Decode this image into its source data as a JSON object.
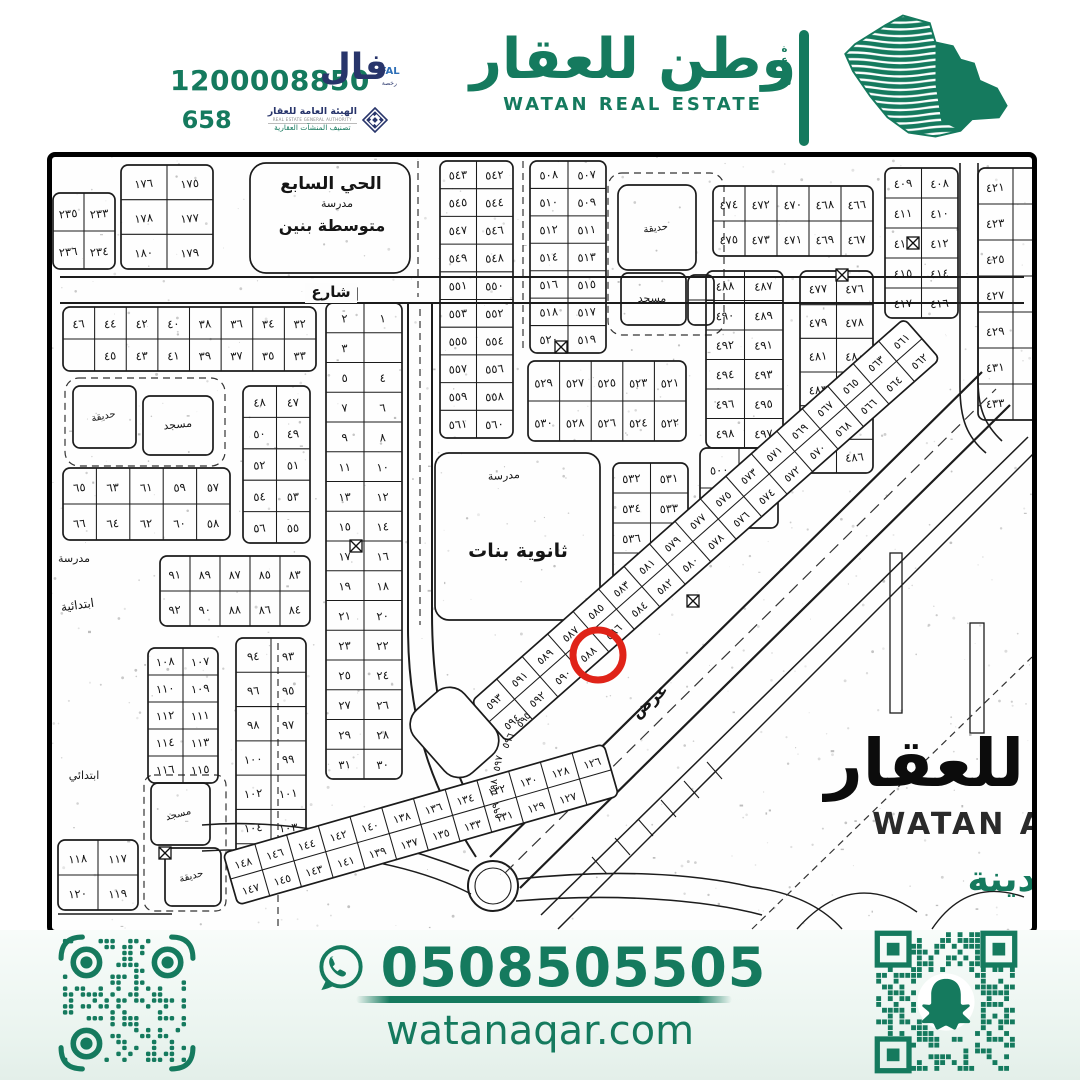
{
  "meta": {
    "accent": "#157a5e",
    "navy": "#28356b",
    "red": "#e02318",
    "ink": "#151515"
  },
  "header": {
    "license_number": "1200008850",
    "license_secondary": "658",
    "fal": {
      "ar": "فال",
      "en": "FAL",
      "sub": "رخصة"
    },
    "authority": {
      "name_ar": "الهيئة العامة للعقار",
      "name_en": "REAL ESTATE GENERAL AUTHORITY",
      "classification": "تصنيف المنشآت العقارية"
    },
    "brand": {
      "name_ar": "وطن للعقار",
      "name_en": "WATAN REAL ESTATE",
      "side_ar": "شمعة"
    }
  },
  "footer": {
    "phone": "0508505505",
    "website": "watanaqar.com"
  },
  "map": {
    "highlight": {
      "plot": "٥٨٩",
      "x": 546,
      "y": 498,
      "r": 25,
      "color": "#e02318"
    },
    "watermark": {
      "ar": "للعقار",
      "en": "WATAN A",
      "city": "دينة"
    },
    "landmarks": [
      {
        "text": "الحي السابع",
        "x": 279,
        "y": 32,
        "size": 17,
        "bold": 1
      },
      {
        "text": "مدرسة",
        "x": 285,
        "y": 50,
        "size": 11
      },
      {
        "text": "متوسطة بنين",
        "x": 280,
        "y": 74,
        "size": 16,
        "bold": 1
      },
      {
        "text": "شارع",
        "x": 279,
        "y": 140,
        "size": 15,
        "bold": 1,
        "bg": 1
      },
      {
        "text": "حديقة",
        "x": 52,
        "y": 262,
        "size": 10,
        "rot": -12
      },
      {
        "text": "مسجد",
        "x": 126,
        "y": 271,
        "size": 11,
        "rot": -6
      },
      {
        "text": "مدرسة",
        "x": 22,
        "y": 405,
        "size": 11
      },
      {
        "text": "ابتدائية",
        "x": 26,
        "y": 452,
        "size": 12,
        "rot": -8
      },
      {
        "text": "مدرسة",
        "x": 452,
        "y": 322,
        "size": 11,
        "rot": -4
      },
      {
        "text": "ثانوية بنات",
        "x": 466,
        "y": 400,
        "size": 19,
        "bold": 1
      },
      {
        "text": "حديقة",
        "x": 604,
        "y": 74,
        "size": 10,
        "rot": -8
      },
      {
        "text": "مسجد",
        "x": 600,
        "y": 145,
        "size": 11
      },
      {
        "text": "ابتدائي",
        "x": 32,
        "y": 622,
        "size": 11
      },
      {
        "text": "مسجد",
        "x": 127,
        "y": 660,
        "size": 10,
        "rot": -15
      },
      {
        "text": "حديقة",
        "x": 140,
        "y": 722,
        "size": 10,
        "rot": -15
      },
      {
        "text": "عرض",
        "x": 601,
        "y": 548,
        "size": 16,
        "rot": -41,
        "bold": 1
      },
      {
        "text": "٥٩٥",
        "x": 474,
        "y": 565,
        "size": 10,
        "rot": -50
      },
      {
        "text": "٥٩٦",
        "x": 459,
        "y": 585,
        "size": 10,
        "rot": -65
      },
      {
        "text": "٥٩٧",
        "x": 449,
        "y": 607,
        "size": 10,
        "rot": -78
      },
      {
        "text": "٥٩٨",
        "x": 445,
        "y": 630,
        "size": 10,
        "rot": -90
      },
      {
        "text": "٥٩٩",
        "x": 448,
        "y": 653,
        "size": 10,
        "rot": -104
      }
    ],
    "blocks": [
      {
        "x": 1,
        "y": 36,
        "w": 62,
        "h": 76,
        "cols": 2,
        "rows": 2,
        "labels": [
          [
            "٢٣٥",
            "٢٣٣"
          ],
          [
            "٢٣٦",
            "٢٣٤"
          ]
        ]
      },
      {
        "x": 69,
        "y": 8,
        "w": 92,
        "h": 104,
        "cols": 2,
        "rows": 3,
        "labels": [
          [
            "١٧٦",
            "١٧٥"
          ],
          [
            "١٧٨",
            "١٧٧"
          ],
          [
            "١٨٠",
            "١٧٩"
          ]
        ]
      },
      {
        "x": 198,
        "y": 6,
        "w": 160,
        "h": 110,
        "cols": 1,
        "rows": 1,
        "rx": 16,
        "labels": [
          [
            ""
          ]
        ]
      },
      {
        "x": 11,
        "y": 150,
        "w": 253,
        "h": 64,
        "cols": 8,
        "rows": 2,
        "labels": [
          [
            "٤٦",
            "٤٤",
            "٤٢",
            "٤٠",
            "٣٨",
            "٣٦",
            "٣٤",
            "٣٢"
          ],
          [
            "",
            "٤٥",
            "٤٣",
            "٤١",
            "٣٩",
            "٣٧",
            "٣٥",
            "٣٣"
          ]
        ]
      },
      {
        "x": 274,
        "y": 146,
        "w": 76,
        "h": 476,
        "cols": 2,
        "rows": 16,
        "labels": [
          [
            "٢",
            "١"
          ],
          [
            "٣",
            ""
          ],
          [
            "٥",
            "٤"
          ],
          [
            "٧",
            "٦"
          ],
          [
            "٩",
            "٨"
          ],
          [
            "١١",
            "١٠"
          ],
          [
            "١٣",
            "١٢"
          ],
          [
            "١٥",
            "١٤"
          ],
          [
            "١٧",
            "١٦"
          ],
          [
            "١٩",
            "١٨"
          ],
          [
            "٢١",
            "٢٠"
          ],
          [
            "٢٣",
            "٢٢"
          ],
          [
            "٢٥",
            "٢٤"
          ],
          [
            "٢٧",
            "٢٦"
          ],
          [
            "٢٩",
            "٢٨"
          ],
          [
            "٣١",
            "٣٠"
          ]
        ]
      },
      {
        "x": 21,
        "y": 229,
        "w": 63,
        "h": 62,
        "cols": 1,
        "rows": 1,
        "labels": [
          [
            ""
          ]
        ]
      },
      {
        "x": 91,
        "y": 239,
        "w": 70,
        "h": 59,
        "cols": 1,
        "rows": 1,
        "labels": [
          [
            ""
          ]
        ]
      },
      {
        "x": 191,
        "y": 229,
        "w": 67,
        "h": 157,
        "cols": 2,
        "rows": 5,
        "labels": [
          [
            "٤٨",
            "٤٧"
          ],
          [
            "٥٠",
            "٤٩"
          ],
          [
            "٥٢",
            "٥١"
          ],
          [
            "٥٤",
            "٥٣"
          ],
          [
            "٥٦",
            "٥٥"
          ]
        ]
      },
      {
        "x": 11,
        "y": 311,
        "w": 167,
        "h": 72,
        "cols": 5,
        "rows": 2,
        "labels": [
          [
            "٦٥",
            "٦٣",
            "٦١",
            "٥٩",
            "٥٧"
          ],
          [
            "٦٦",
            "٦٤",
            "٦٢",
            "٦٠",
            "٥٨"
          ]
        ]
      },
      {
        "x": 108,
        "y": 399,
        "w": 150,
        "h": 70,
        "cols": 5,
        "rows": 2,
        "labels": [
          [
            "٩١",
            "٨٩",
            "٨٧",
            "٨٥",
            "٨٣"
          ],
          [
            "٩٢",
            "٩٠",
            "٨٨",
            "٨٦",
            "٨٤"
          ]
        ]
      },
      {
        "x": 184,
        "y": 481,
        "w": 70,
        "h": 240,
        "cols": 2,
        "rows": 7,
        "labels": [
          [
            "٩٤",
            "٩٣"
          ],
          [
            "٩٦",
            "٩٥"
          ],
          [
            "٩٨",
            "٩٧"
          ],
          [
            "١٠٠",
            "٩٩"
          ],
          [
            "١٠٢",
            "١٠١"
          ],
          [
            "١٠٤",
            "١٠٣"
          ],
          [
            "١٠٦",
            "١٠٥"
          ]
        ]
      },
      {
        "x": 96,
        "y": 491,
        "w": 70,
        "h": 135,
        "cols": 2,
        "rows": 5,
        "labels": [
          [
            "١٠٨",
            "١٠٧"
          ],
          [
            "١١٠",
            "١٠٩"
          ],
          [
            "١١٢",
            "١١١"
          ],
          [
            "١١٤",
            "١١٣"
          ],
          [
            "١١٦",
            "١١٥"
          ]
        ]
      },
      {
        "x": 99,
        "y": 626,
        "w": 59,
        "h": 62,
        "cols": 1,
        "rows": 1,
        "labels": [
          [
            ""
          ]
        ]
      },
      {
        "x": 113,
        "y": 691,
        "w": 56,
        "h": 58,
        "cols": 1,
        "rows": 1,
        "labels": [
          [
            ""
          ]
        ]
      },
      {
        "x": 6,
        "y": 683,
        "w": 80,
        "h": 70,
        "cols": 2,
        "rows": 2,
        "labels": [
          [
            "١١٨",
            "١١٧"
          ],
          [
            "١٢٠",
            "١١٩"
          ]
        ]
      },
      {
        "x": 383,
        "y": 296,
        "w": 165,
        "h": 167,
        "cols": 1,
        "rows": 1,
        "rx": 14,
        "labels": [
          [
            ""
          ]
        ]
      },
      {
        "x": 561,
        "y": 306,
        "w": 75,
        "h": 120,
        "cols": 2,
        "rows": 4,
        "labels": [
          [
            "٥٣٢",
            "٥٣١"
          ],
          [
            "٥٣٤",
            "٥٣٣"
          ],
          [
            "٥٣٦",
            "٥٣٥"
          ],
          [
            "",
            "٥٣٧"
          ]
        ]
      },
      {
        "x": 388,
        "y": 4,
        "w": 73,
        "h": 277,
        "cols": 2,
        "rows": 10,
        "labels": [
          [
            "٥٤٣",
            "٥٤٢"
          ],
          [
            "٥٤٥",
            "٥٤٤"
          ],
          [
            "٥٤٧",
            "٥٤٦"
          ],
          [
            "٥٤٩",
            "٥٤٨"
          ],
          [
            "٥٥١",
            "٥٥٠"
          ],
          [
            "٥٥٣",
            "٥٥٢"
          ],
          [
            "٥٥٥",
            "٥٥٤"
          ],
          [
            "٥٥٧",
            "٥٥٦"
          ],
          [
            "٥٥٩",
            "٥٥٨"
          ],
          [
            "٥٦١",
            "٥٦٠"
          ]
        ]
      },
      {
        "x": 478,
        "y": 4,
        "w": 76,
        "h": 192,
        "cols": 2,
        "rows": 7,
        "labels": [
          [
            "٥٠٨",
            "٥٠٧"
          ],
          [
            "٥١٠",
            "٥٠٩"
          ],
          [
            "٥١٢",
            "٥١١"
          ],
          [
            "٥١٤",
            "٥١٣"
          ],
          [
            "٥١٦",
            "٥١٥"
          ],
          [
            "٥١٨",
            "٥١٧"
          ],
          [
            "٥٢٠",
            "٥١٩"
          ]
        ]
      },
      {
        "x": 566,
        "y": 28,
        "w": 78,
        "h": 85,
        "cols": 1,
        "rows": 1,
        "rx": 10,
        "labels": [
          [
            ""
          ]
        ]
      },
      {
        "x": 569,
        "y": 116,
        "w": 65,
        "h": 52,
        "cols": 1,
        "rows": 1,
        "labels": [
          [
            ""
          ]
        ]
      },
      {
        "x": 636,
        "y": 118,
        "w": 26,
        "h": 50,
        "cols": 1,
        "rows": 2,
        "labels": [
          [
            ""
          ],
          [
            ""
          ]
        ]
      },
      {
        "x": 476,
        "y": 204,
        "w": 158,
        "h": 80,
        "cols": 5,
        "rows": 2,
        "labels": [
          [
            "٥٢٩",
            "٥٢٧",
            "٥٢٥",
            "٥٢٣",
            "٥٢١"
          ],
          [
            "٥٣٠",
            "٥٢٨",
            "٥٢٦",
            "٥٢٤",
            "٥٢٢"
          ]
        ]
      },
      {
        "x": 648,
        "y": 291,
        "w": 78,
        "h": 80,
        "cols": 2,
        "rows": 2,
        "labels": [
          [
            "٥٠٠",
            "٤٩٩"
          ],
          [
            "٥٠٢",
            "٥٠١"
          ]
        ]
      },
      {
        "x": 661,
        "y": 29,
        "w": 160,
        "h": 70,
        "cols": 5,
        "rows": 2,
        "labels": [
          [
            "٤٧٤",
            "٤٧٢",
            "٤٧٠",
            "٤٦٨",
            "٤٦٦"
          ],
          [
            "٤٧٥",
            "٤٧٣",
            "٤٧١",
            "٤٦٩",
            "٤٦٧"
          ]
        ]
      },
      {
        "x": 654,
        "y": 114,
        "w": 77,
        "h": 177,
        "cols": 2,
        "rows": 6,
        "labels": [
          [
            "٤٨٨",
            "٤٨٧"
          ],
          [
            "٤٩٠",
            "٤٨٩"
          ],
          [
            "٤٩٢",
            "٤٩١"
          ],
          [
            "٤٩٤",
            "٤٩٣"
          ],
          [
            "٤٩٦",
            "٤٩٥"
          ],
          [
            "٤٩٨",
            "٤٩٧"
          ]
        ]
      },
      {
        "x": 748,
        "y": 114,
        "w": 73,
        "h": 202,
        "cols": 2,
        "rows": 6,
        "labels": [
          [
            "٤٧٧",
            "٤٧٦"
          ],
          [
            "٤٧٩",
            "٤٧٨"
          ],
          [
            "٤٨١",
            "٤٨٠"
          ],
          [
            "٤٨٣",
            "٤٨٢"
          ],
          [
            "٤٨٥",
            "٤٨٤"
          ],
          [
            "",
            "٤٨٦"
          ]
        ]
      },
      {
        "x": 833,
        "y": 11,
        "w": 73,
        "h": 150,
        "cols": 2,
        "rows": 5,
        "labels": [
          [
            "٤٠٩",
            "٤٠٨"
          ],
          [
            "٤١١",
            "٤١٠"
          ],
          [
            "٤١٣",
            "٤١٢"
          ],
          [
            "٤١٥",
            "٤١٤"
          ],
          [
            "٤١٧",
            "٤١٦"
          ]
        ]
      },
      {
        "x": 926,
        "y": 11,
        "w": 70,
        "h": 252,
        "cols": 2,
        "rows": 7,
        "labels": [
          [
            "٤٢١",
            ""
          ],
          [
            "٤٢٣",
            ""
          ],
          [
            "٤٢٥",
            ""
          ],
          [
            "٤٢٧",
            ""
          ],
          [
            "٤٢٩",
            ""
          ],
          [
            "٤٣١",
            ""
          ],
          [
            "٤٣٣",
            ""
          ]
        ]
      }
    ],
    "strips": [
      {
        "x": 455,
        "y": 585,
        "angle": -41.5,
        "cellW": 34,
        "cellH": 27,
        "rows": [
          [
            "٥٩٣",
            "٥٩١",
            "٥٨٩",
            "٥٨٧",
            "٥٨٥",
            "٥٨٣",
            "٥٨١",
            "٥٧٩",
            "٥٧٧",
            "٥٧٥",
            "٥٧٣",
            "٥٧١",
            "٥٦٩",
            "٥٦٧",
            "٥٦٥",
            "٥٦٣",
            "٥٦١"
          ],
          [
            "٥٩٤",
            "٥٩٢",
            "٥٩٠",
            "٥٨٨",
            "٥٨٦",
            "٥٨٤",
            "٥٨٢",
            "٥٨٠",
            "٥٧٨",
            "٥٧٦",
            "٥٧٤",
            "٥٧٢",
            "٥٧٠",
            "٥٦٨",
            "٥٦٦",
            "٥٦٤",
            "٥٦٢"
          ]
        ]
      },
      {
        "x": 455,
        "y": 585,
        "angle": -41.5,
        "dx": -66,
        "cellW": 66,
        "cellH": 84,
        "rx": 20,
        "rows": [
          [
            ""
          ]
        ]
      },
      {
        "x": 186,
        "y": 748,
        "angle": -16,
        "cellW": 33,
        "cellH": 27,
        "rows": [
          [
            "١٤٨",
            "١٤٦",
            "١٤٤",
            "١٤٢",
            "١٤٠",
            "١٣٨",
            "١٣٦",
            "١٣٤",
            "١٣٢",
            "١٣٠",
            "١٢٨",
            "١٢٦"
          ],
          [
            "١٤٧",
            "١٤٥",
            "١٤٣",
            "١٤١",
            "١٣٩",
            "١٣٧",
            "١٣٥",
            "١٣٣",
            "١٣١",
            "١٢٩",
            "١٢٧",
            ""
          ]
        ]
      }
    ],
    "marks": [
      [
        299,
        137
      ],
      [
        509,
        190
      ],
      [
        790,
        118
      ],
      [
        304,
        389
      ],
      [
        113,
        696
      ],
      [
        641,
        444
      ],
      [
        861,
        86
      ]
    ]
  }
}
